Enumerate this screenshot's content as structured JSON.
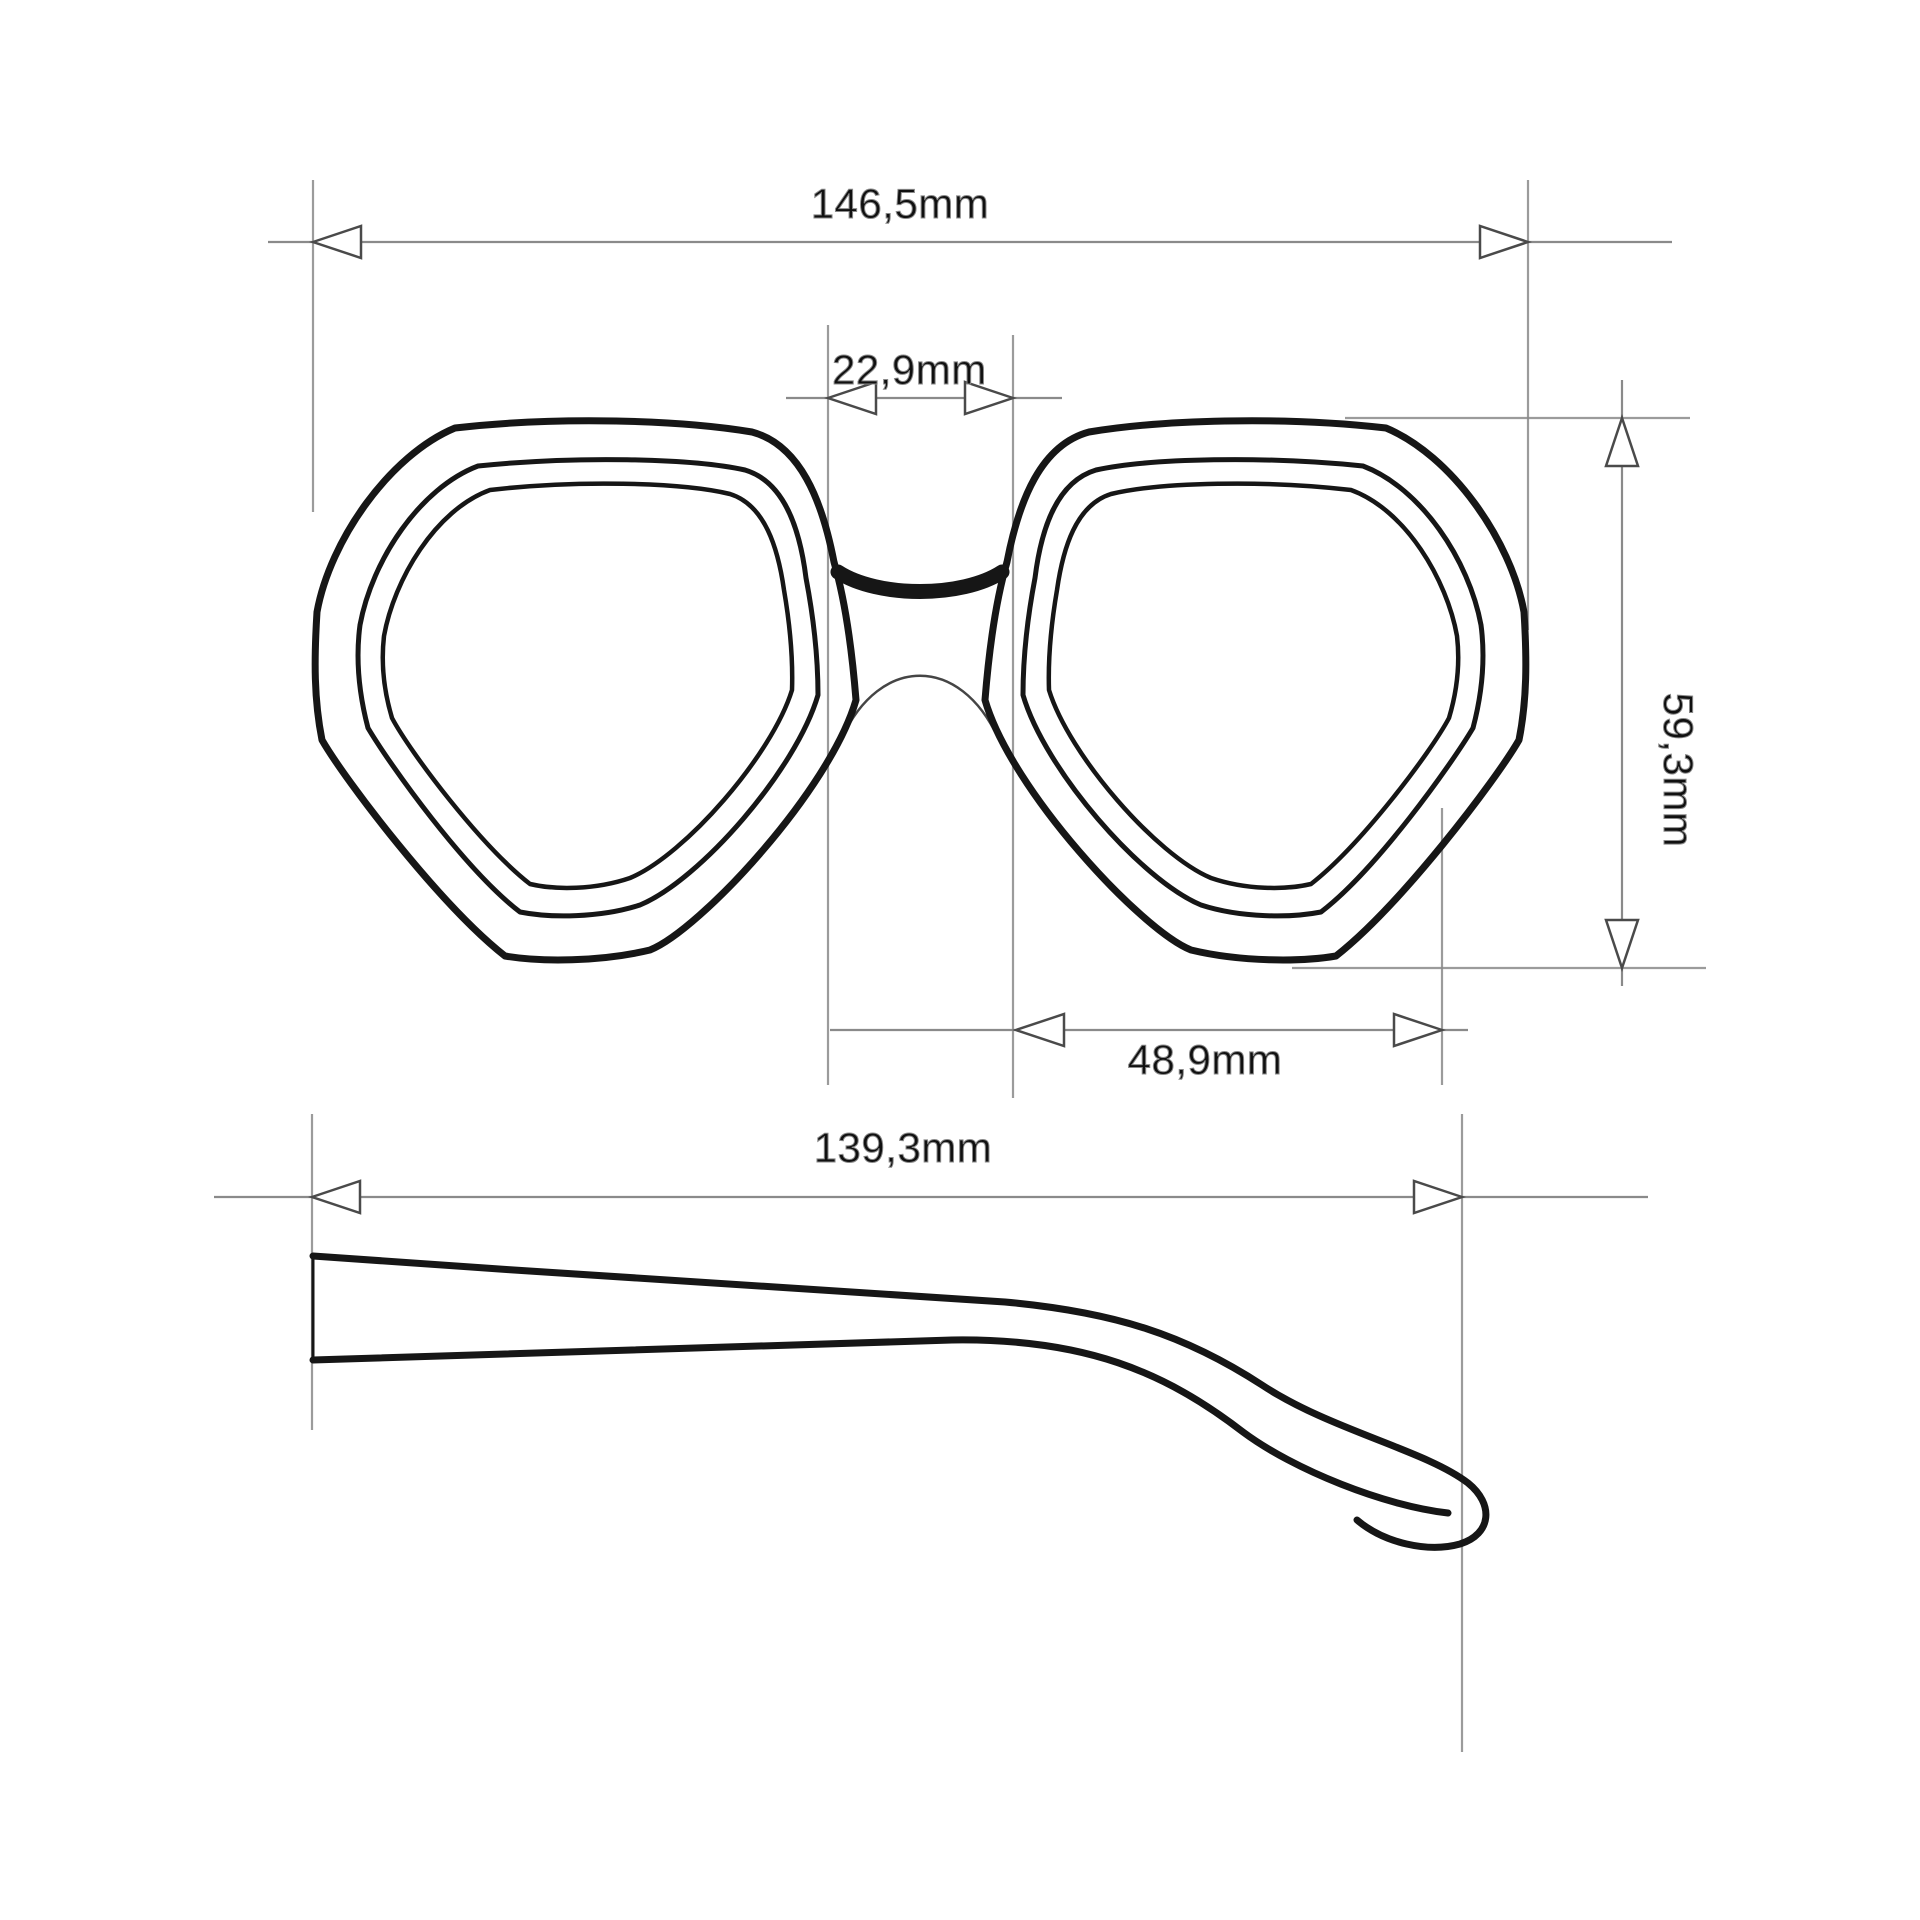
{
  "drawing": {
    "subject": "sunglasses-technical-dimension-drawing",
    "unit": "mm",
    "decimal_style": "comma"
  },
  "measurements": {
    "frame_total_width": {
      "label": "146,5mm",
      "value_mm": 146.5
    },
    "bridge_width": {
      "label": "22,9mm",
      "value_mm": 22.9
    },
    "lens_height": {
      "label": "59,3mm",
      "value_mm": 59.3
    },
    "lens_width": {
      "label": "48,9mm",
      "value_mm": 48.9
    },
    "temple_length": {
      "label": "139,3mm",
      "value_mm": 139.3
    }
  },
  "style": {
    "line_color": "#161616",
    "dimension_line_color": "#8a8a8a",
    "arrow_outline_color": "#4a4a4a",
    "text_color": "#101010",
    "background": "#ffffff"
  }
}
